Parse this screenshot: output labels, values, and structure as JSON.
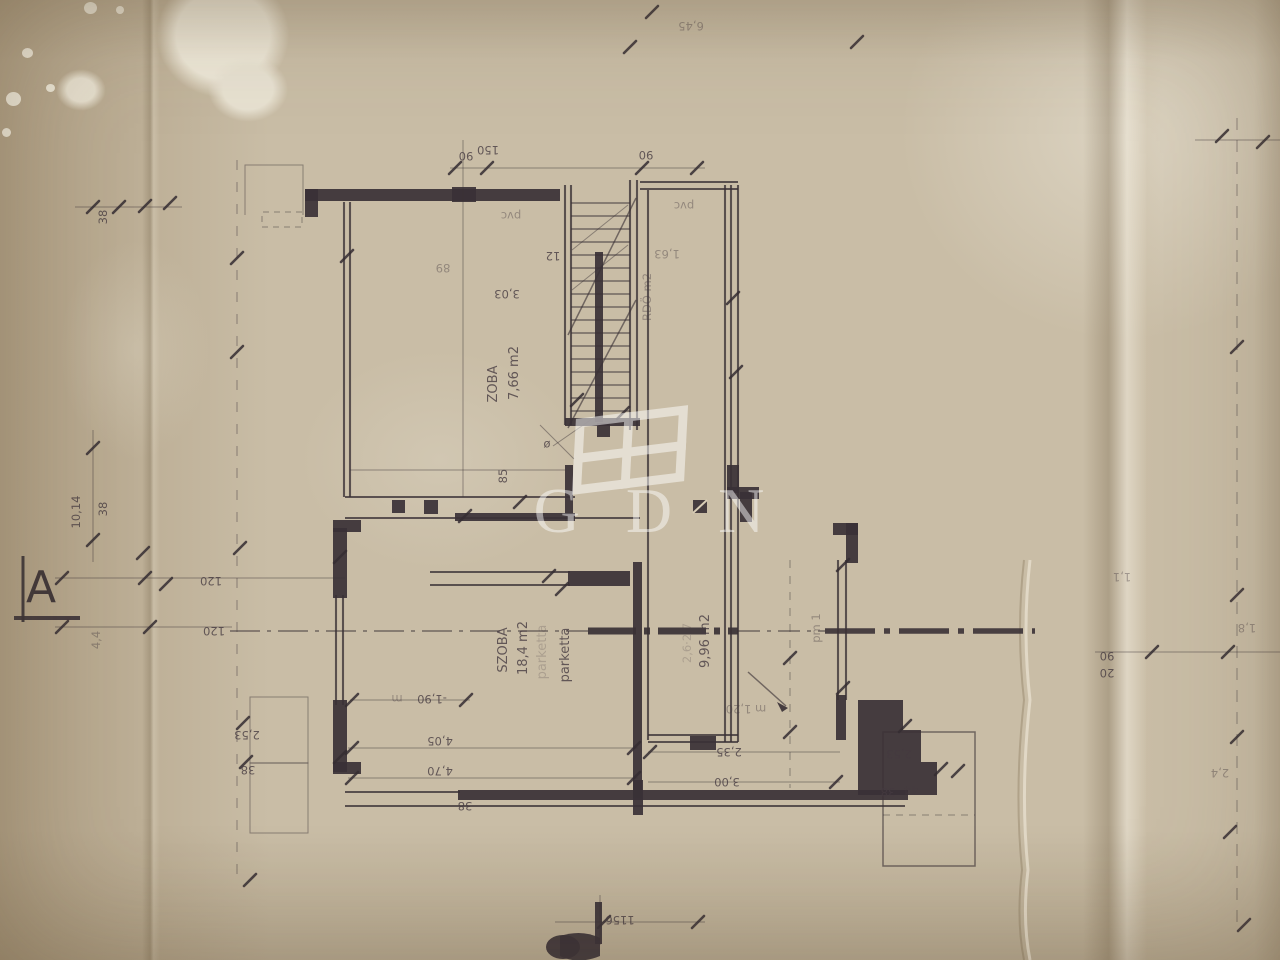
{
  "watermark": {
    "text": "GDN"
  },
  "marker": {
    "a": "A"
  },
  "colors": {
    "ink": "#3a3136",
    "paper": "#c9bda6",
    "watermark": "#ffffff"
  },
  "labels": {
    "top_dim": "6,45",
    "dim90a": "90",
    "dim150": "150",
    "dim90b": "90",
    "pvc1": "pvc",
    "pvc2": "pvc",
    "stair12": "12",
    "stair303": "3,03",
    "room_up_name": "ZOBA",
    "room_up_area": "7,66 m2",
    "bath": "RDÖ m2",
    "dim163": "1,63",
    "dim85": "85",
    "diam": "ø",
    "dim89": "89",
    "dim1014": "10,14",
    "dim38a": "38",
    "dim38b": "38",
    "dim120a": "120",
    "dim120b": "120",
    "level_m": "m",
    "dim190": "-1,90",
    "dim405": "4,05",
    "dim470": "4,70",
    "dim38c": "38",
    "room1_name": "SZOBA",
    "room1_area": "18,4 m2",
    "room1_floor_ghost": "parketta",
    "room1_floor": "parketta",
    "room2_ghost": "2,6·2,7",
    "room2_area": "9,96 m2",
    "pm1": "pm 1",
    "level2": "m 1,20",
    "dim235": "2,35",
    "dim300": "3,00",
    "dim253r": "2,53",
    "dim38r": "38",
    "dim44r": "44",
    "dim253l": "2,53",
    "dim38l": "38",
    "dim90r": "90",
    "dim20r": "20",
    "dim11": "1,1",
    "dim18": "1,8",
    "dim24": "2,4",
    "dim44l": "4,4",
    "dim1156": "1156"
  }
}
